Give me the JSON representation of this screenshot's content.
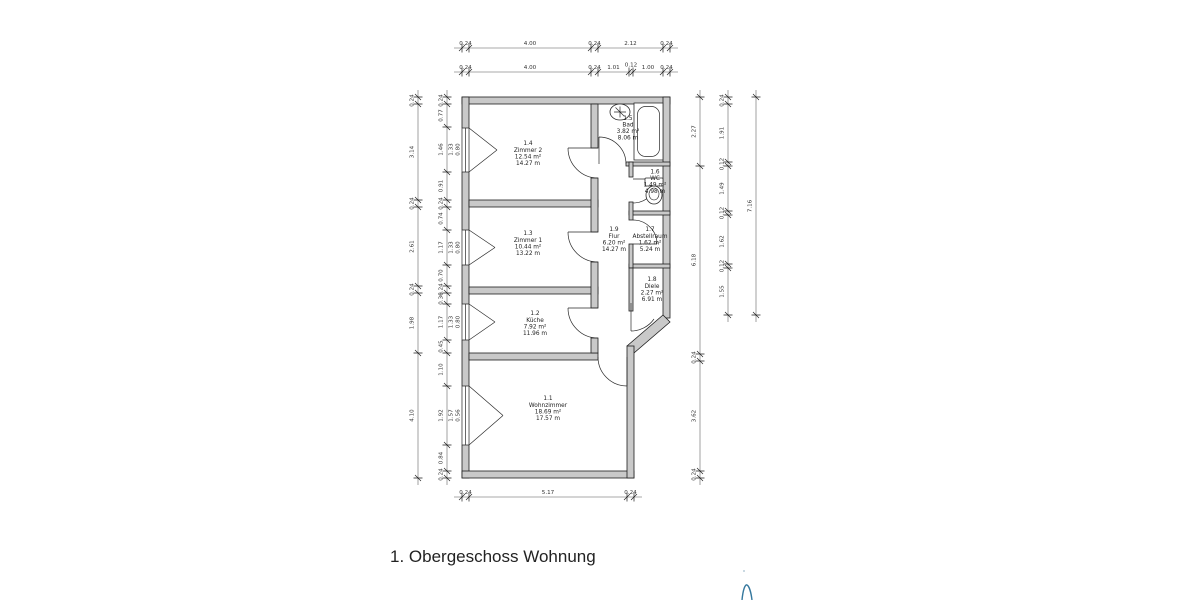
{
  "title": "1. Obergeschoss Wohnung",
  "rooms": {
    "wohnzimmer": {
      "num": "1.1",
      "name": "Wohnzimmer",
      "area": "18.69 m²",
      "perim": "17.57 m"
    },
    "kueche": {
      "num": "1.2",
      "name": "Küche",
      "area": "7.92 m²",
      "perim": "11.96 m"
    },
    "zimmer1": {
      "num": "1.3",
      "name": "Zimmer 1",
      "area": "10.44 m²",
      "perim": "13.22 m"
    },
    "zimmer2": {
      "num": "1.4",
      "name": "Zimmer 2",
      "area": "12.54 m²",
      "perim": "14.27 m"
    },
    "bad": {
      "num": "1.5",
      "name": "Bad",
      "area": "3.82 m²",
      "perim": "8.06 m"
    },
    "wc": {
      "num": "1.6",
      "name": "WC",
      "area": "1.49 m²",
      "perim": "4.98 m"
    },
    "abstellraum": {
      "num": "1.7",
      "name": "Abstellraum",
      "area": "1.62 m²",
      "perim": "5.24 m"
    },
    "diele": {
      "num": "1.8",
      "name": "Diele",
      "area": "2.27 m²",
      "perim": "6.91 m"
    },
    "flur": {
      "num": "1.9",
      "name": "Flur",
      "area": "6.20 m²",
      "perim": "14.27 m"
    }
  },
  "dims": {
    "top1": [
      "0.24",
      "4.00",
      "0.24",
      "2.12",
      "0.24"
    ],
    "top2": [
      "0.24",
      "4.00",
      "0.24",
      "1.01",
      "0.12",
      "1.00",
      "0.24"
    ],
    "left_outer": [
      "0.24",
      "3.14",
      "0.24",
      "2.61",
      "0.24",
      "1.98",
      "4.10"
    ],
    "left_inner": [
      "0.24",
      "0.77",
      "1.46",
      "0.91",
      "0.24",
      "0.74",
      "1.17",
      "0.70",
      "0.24",
      "0.36",
      "1.17",
      "0.45",
      "1.10",
      "1.92",
      "0.84",
      "0.24"
    ],
    "win1": [
      "1.33",
      "0.80"
    ],
    "win2": [
      "1.33",
      "0.80"
    ],
    "win3": [
      "1.33",
      "0.80"
    ],
    "win4": [
      "1.57",
      "0.56"
    ],
    "right_inner": [
      "2.27",
      "6.18",
      "0.24",
      "3.62",
      "0.24"
    ],
    "right_mid": [
      "0.24",
      "1.91",
      "0.12",
      "1.49",
      "0.12",
      "1.62",
      "0.12",
      "1.55"
    ],
    "right_outer": "7.16",
    "bottom": [
      "0.24",
      "5.17",
      "0.24"
    ]
  },
  "colors": {
    "wall_fill": "#c9c9c9",
    "annotation": "#35789e"
  }
}
